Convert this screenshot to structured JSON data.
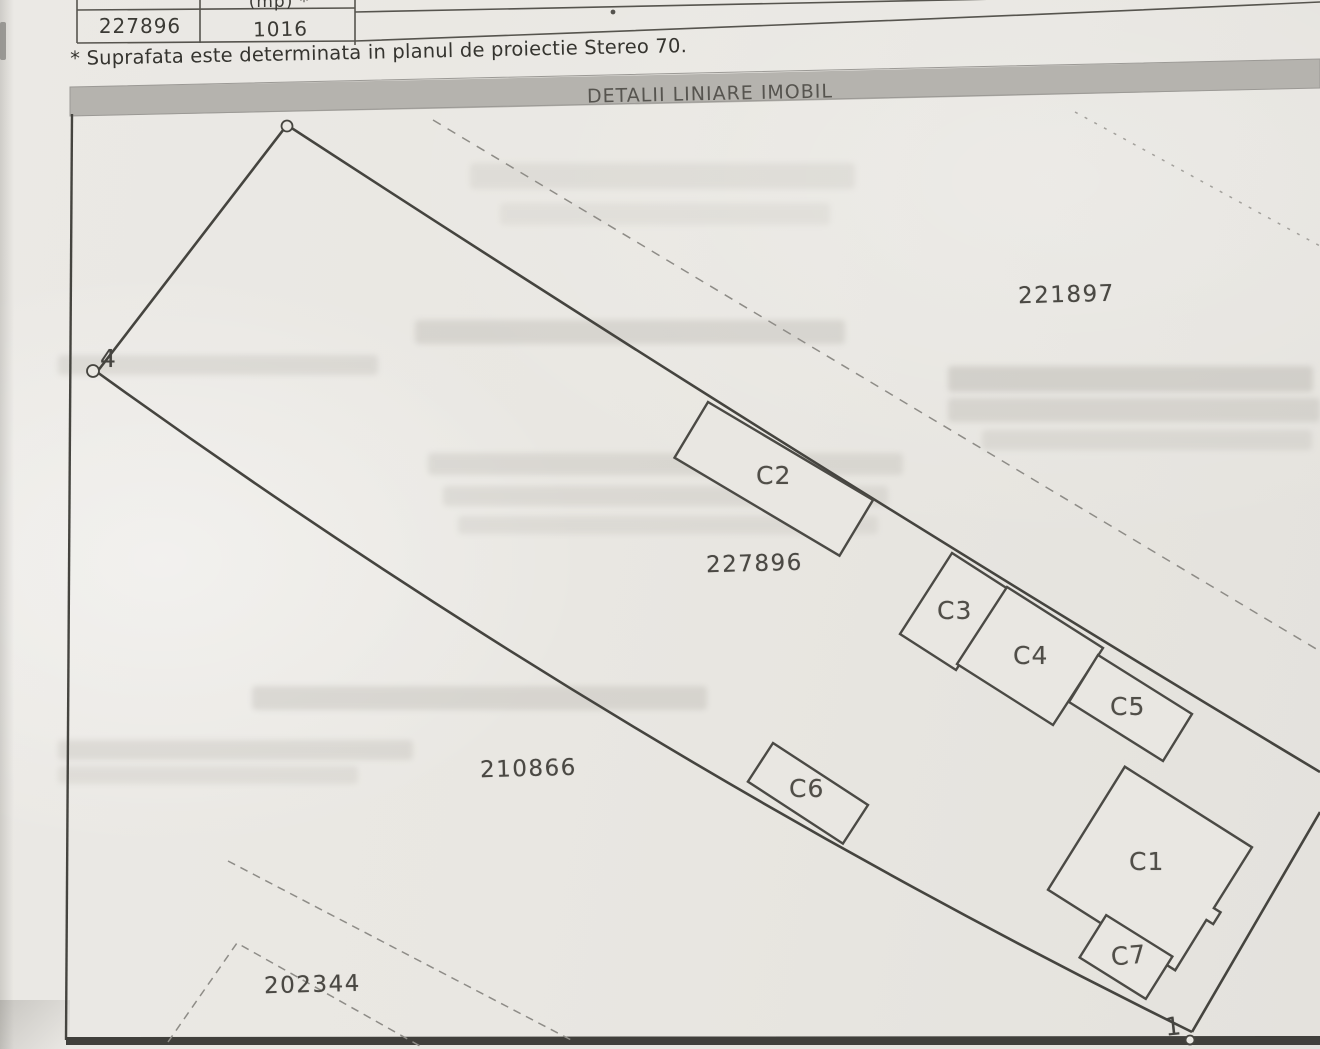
{
  "table": {
    "header_fragment": "(mp) *",
    "cadastral_number": "227896",
    "surface_value": "1016"
  },
  "note": "* Suprafata este determinata in planul de proiectie Stereo 70.",
  "plan": {
    "title": "DETALII LINIARE IMOBIL",
    "parcels": {
      "top_right": "221897",
      "main": "227896",
      "lower": "210866",
      "bottom_left": "202344"
    },
    "buildings": {
      "c1": "C1",
      "c2": "C2",
      "c3": "C3",
      "c4": "C4",
      "c5": "C5",
      "c6": "C6",
      "c7": "C7"
    },
    "points": {
      "left": "4",
      "bottom_right": "1"
    }
  },
  "colors": {
    "paper": "#e9e7e2",
    "header_bar": "#b5b3ae",
    "boundary_line": "#45443f",
    "dashed_line": "#8e8c87",
    "text": "#3b3a35"
  }
}
